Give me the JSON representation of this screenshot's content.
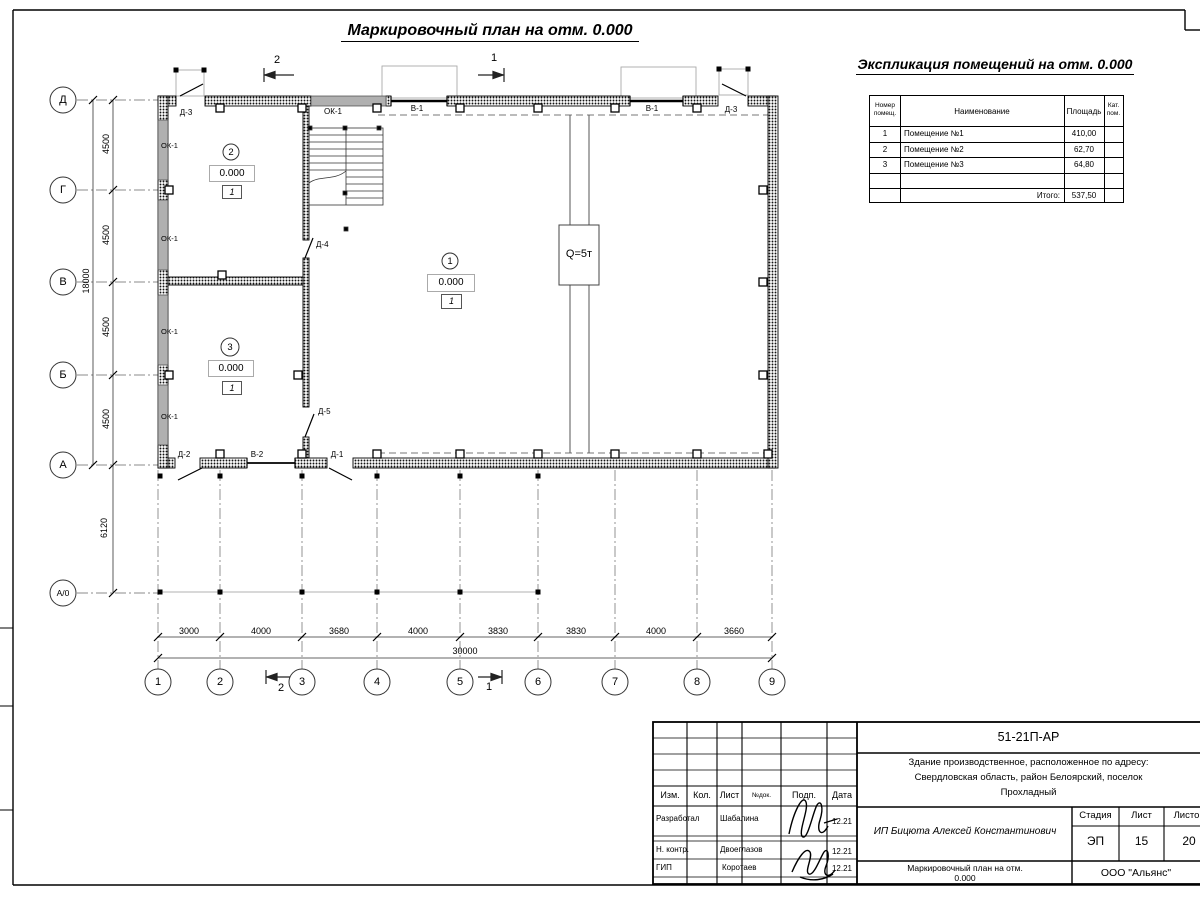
{
  "page": {
    "main_title": "Маркировочный план на отм. 0.000"
  },
  "explication": {
    "title": "Экспликация помещений на отм. 0.000",
    "header": {
      "num_l1": "Номер",
      "num_l2": "помещ.",
      "name": "Наименование",
      "area": "Площадь",
      "cat_l1": "Кат.",
      "cat_l2": "пом."
    },
    "rows": [
      {
        "num": "1",
        "name": "Помещение №1",
        "area": "410,00"
      },
      {
        "num": "2",
        "name": "Помещение №2",
        "area": "62,70"
      },
      {
        "num": "3",
        "name": "Помещение №3",
        "area": "64,80"
      }
    ],
    "total_label": "Итого:",
    "total_value": "537,50"
  },
  "plan": {
    "axes_vertical": [
      "Д",
      "Г",
      "В",
      "Б",
      "А",
      "А/0"
    ],
    "axes_horizontal": [
      "1",
      "2",
      "3",
      "4",
      "5",
      "6",
      "7",
      "8",
      "9"
    ],
    "dims_vertical": [
      "4500",
      "4500",
      "4500",
      "4500"
    ],
    "dim_total_vertical": "18000",
    "dim_offset_vertical": "6120",
    "dims_horizontal": [
      "3000",
      "4000",
      "3680",
      "4000",
      "3830",
      "3830",
      "4000",
      "3660"
    ],
    "dim_total_horizontal": "30000",
    "marks": {
      "window": "ОК-1",
      "gate1": "В-1",
      "gate2": "В-2",
      "door1": "Д-1",
      "door2": "Д-2",
      "door3": "Д-3",
      "door4": "Д-4",
      "door5": "Д-5"
    },
    "crane_label": "Q=5т",
    "sections": {
      "s1": "1",
      "s2": "2"
    },
    "rooms": [
      {
        "num": "1",
        "elev": "0.000",
        "cat": "1"
      },
      {
        "num": "2",
        "elev": "0.000",
        "cat": "1"
      },
      {
        "num": "3",
        "elev": "0.000",
        "cat": "1"
      }
    ]
  },
  "titleblock": {
    "doc_number": "51-21П-АР",
    "project_line1": "Здание производственное, расположенное по адресу:",
    "project_line2": "Свердловская область, район Белоярский, поселок",
    "project_line3": "Прохладный",
    "client": "ИП Бицюта Алексей Константинович",
    "cols": {
      "izm": "Изм.",
      "kol": "Кол.",
      "list": "Лист",
      "doc": "№док.",
      "podp": "Подп.",
      "data": "Дата"
    },
    "rows": [
      {
        "role": "Разработал",
        "name": "Шабалина",
        "date": "12.21"
      },
      {
        "role": "Н. контр.",
        "name": "Двоеглазов",
        "date": "12.21"
      },
      {
        "role": "ГИП",
        "name": "Коротаев",
        "date": "12.21"
      }
    ],
    "stage_label": "Стадия",
    "sheet_label": "Лист",
    "sheets_label": "Листов",
    "stage": "ЭП",
    "sheet": "15",
    "sheets": "20",
    "sheet_title_line1": "Маркировочный план на отм.",
    "sheet_title_line2": "0.000",
    "company": "ООО \"Альянс\""
  }
}
